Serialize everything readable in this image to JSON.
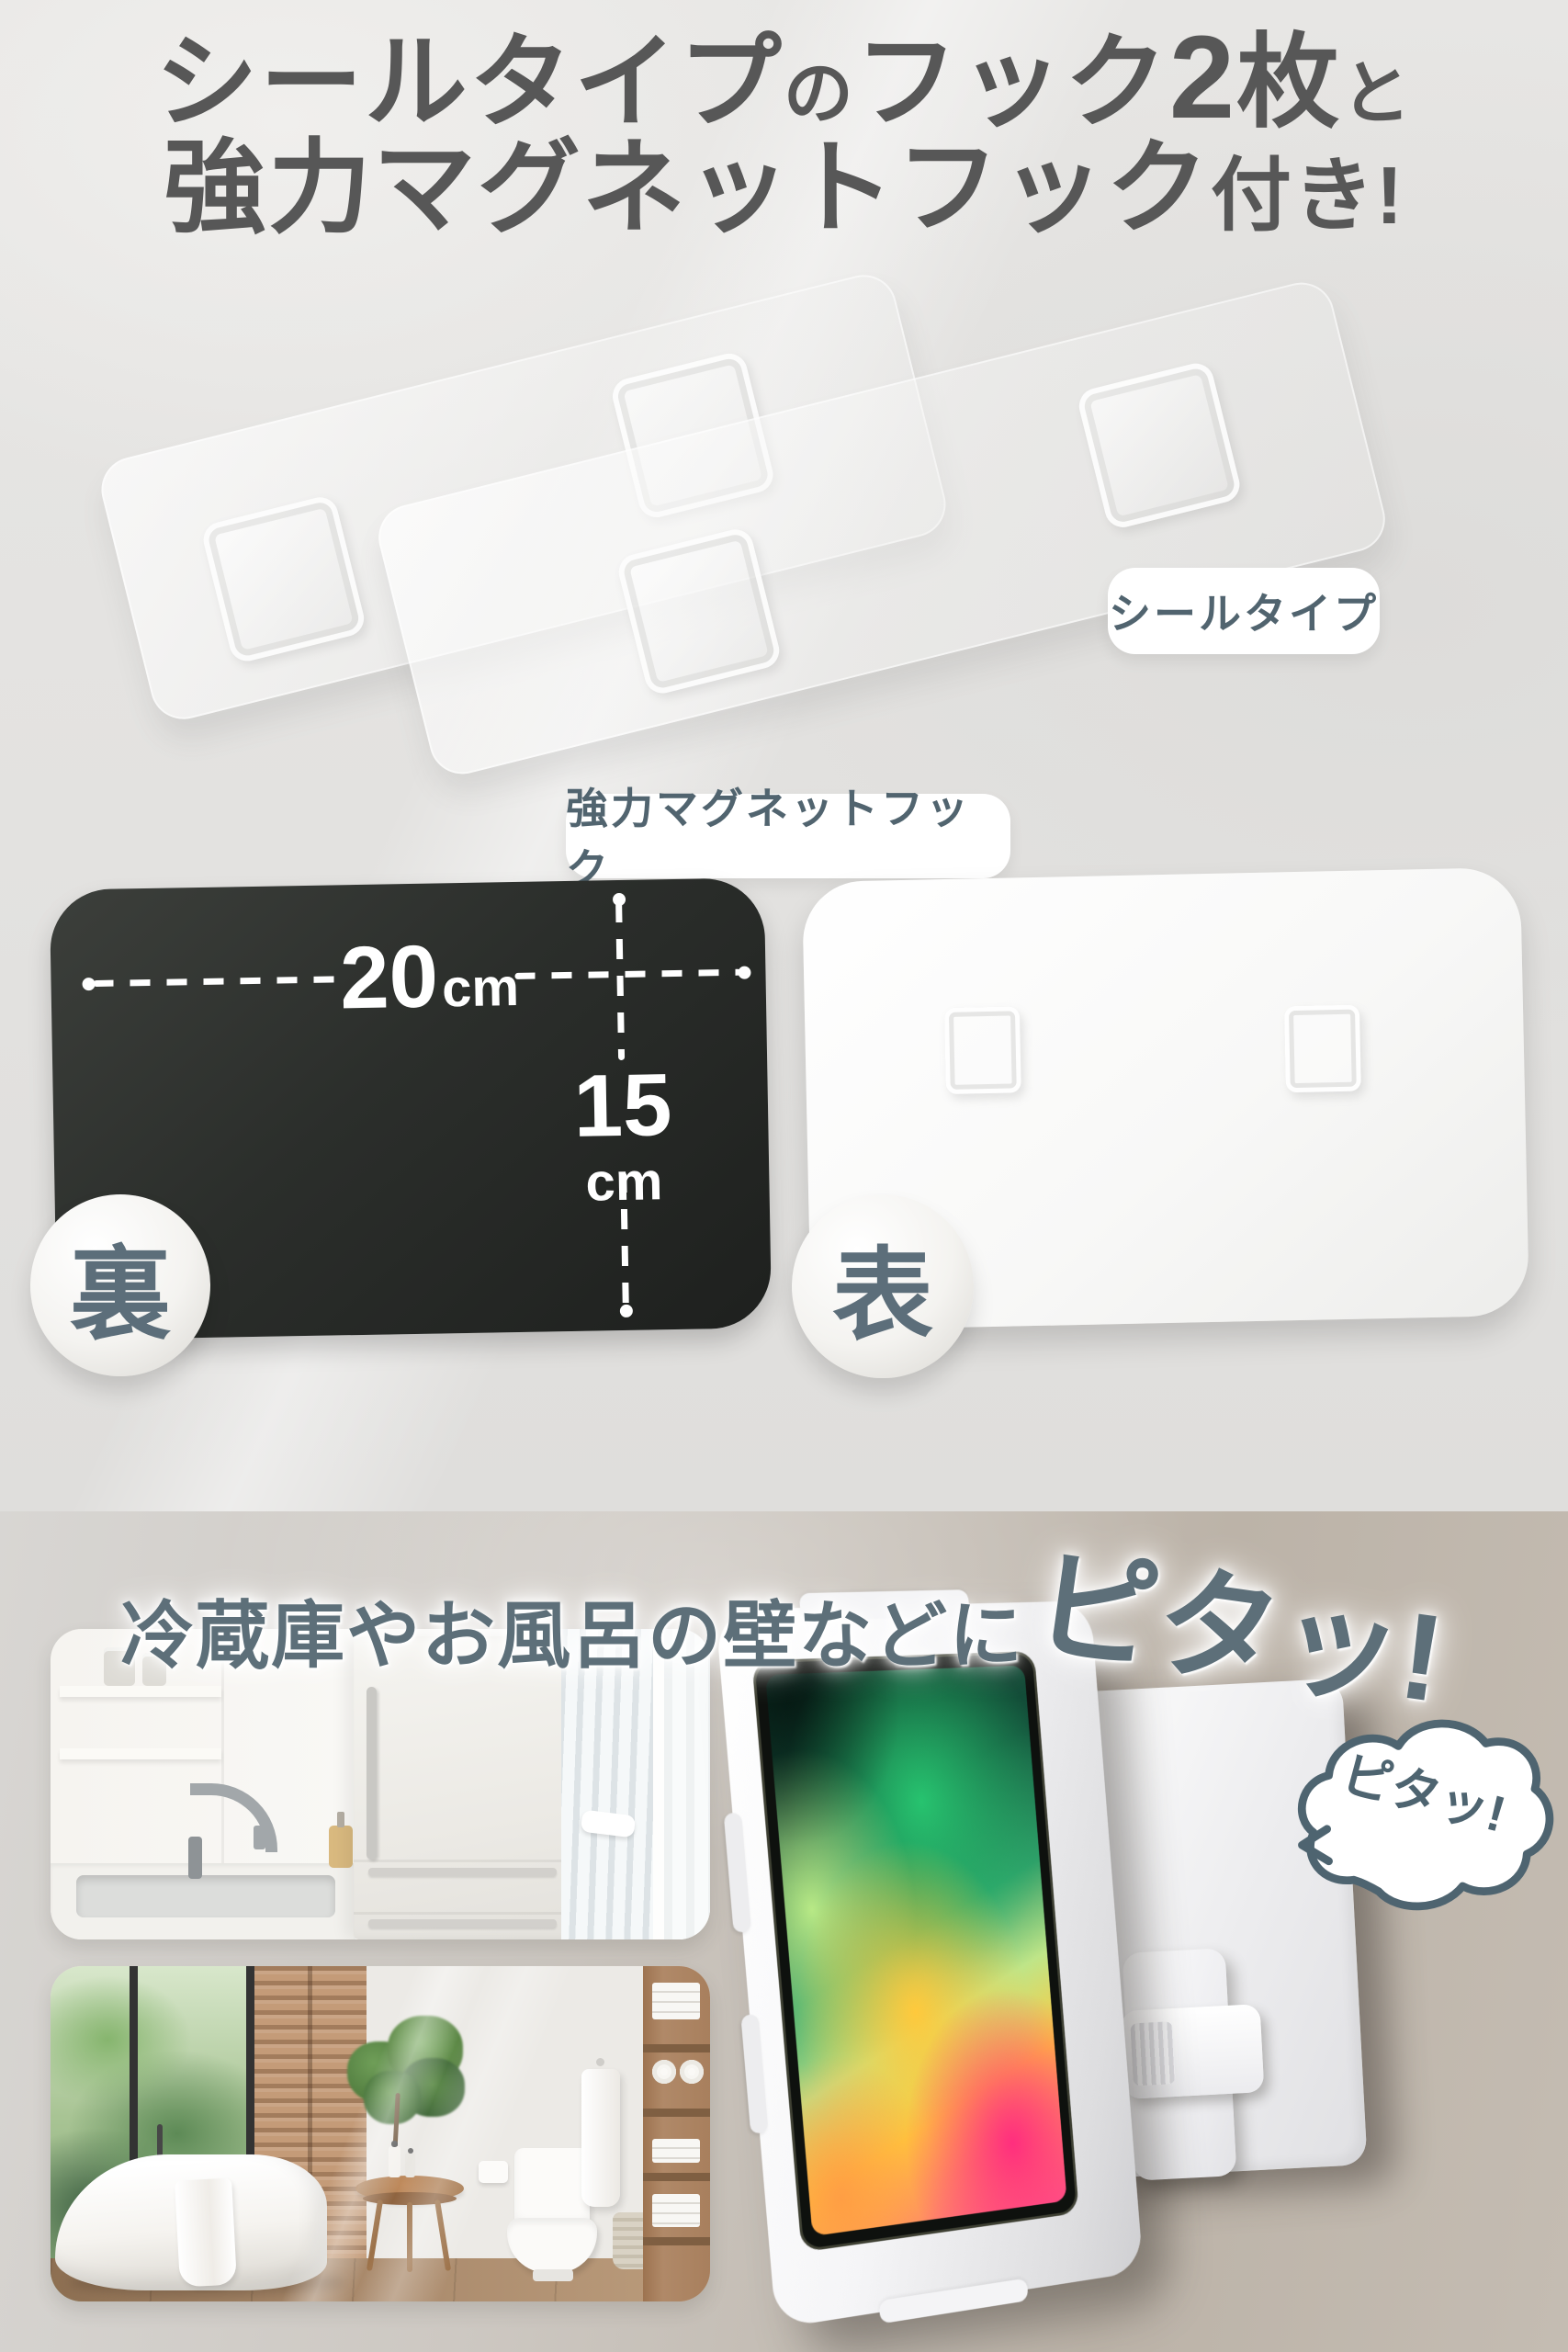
{
  "colors": {
    "title_text": "#575757",
    "pill_label_text": "#51646f",
    "headline_bottom_text": "#5d6f79",
    "bubble_outline": "#4e6470",
    "dimension_text": "#ffffff",
    "black_sheet": "#2b2e2b",
    "top_wall": "#e4e3e1",
    "bottom_wall_left": "#d8d6d3",
    "bottom_wall_right": "#bcb3a8"
  },
  "header": {
    "line1": {
      "seg_large1": "シールタイプ",
      "seg_small1": "の",
      "seg_large2": "フック",
      "seg_number": "2",
      "seg_large3": "枚",
      "seg_small2": "と"
    },
    "line2": {
      "seg_large": "強力マグネットフック",
      "seg_small": "付き!"
    }
  },
  "seal_hooks": {
    "label": "シールタイプ"
  },
  "magnet_hook": {
    "label": "強力マグネットフック",
    "back_badge": "裏",
    "front_badge": "表",
    "width": {
      "value": "20",
      "unit": "cm"
    },
    "height": {
      "value": "15",
      "unit": "cm"
    }
  },
  "usage": {
    "headline_main": "冷蔵庫やお風呂の壁などに",
    "headline_emphasis": "ピタッ!",
    "bubble_text": "ピタッ!"
  }
}
